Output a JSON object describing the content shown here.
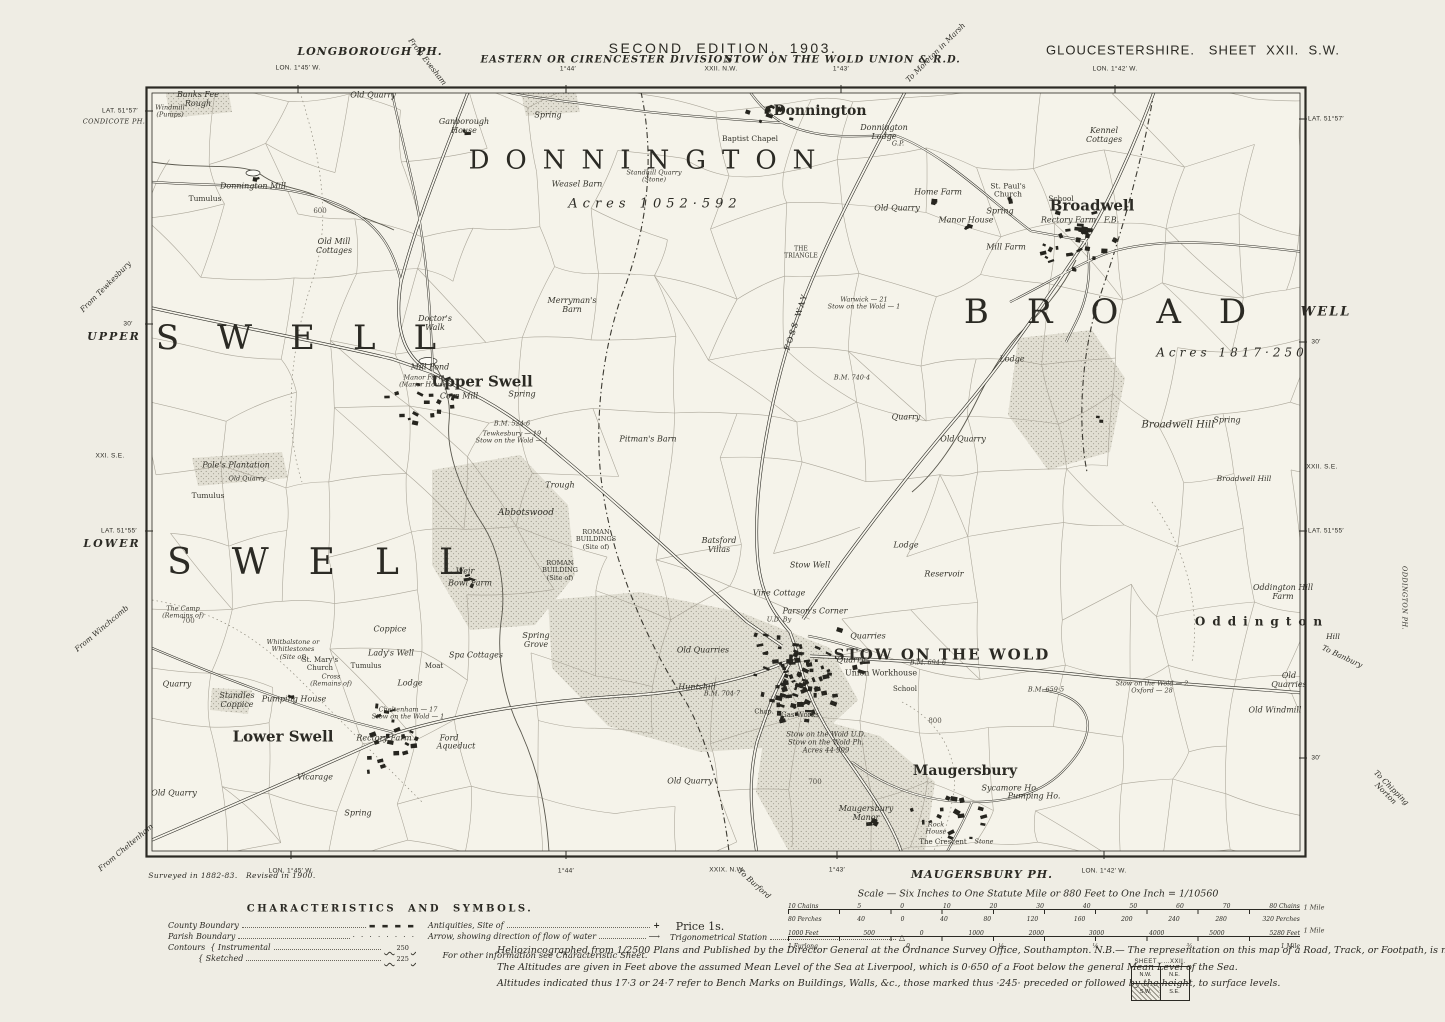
{
  "colors": {
    "paper": "#efede4",
    "map_interior": "#f5f3ea",
    "ink": "#2b2a24",
    "shade": "#dad7ca"
  },
  "header": {
    "edition_title": "SECOND  EDITION,  1903.",
    "county_sheet": "GLOUCESTERSHIRE.   SHEET  XXII.  S.W.",
    "division": "EASTERN OR CIRENCESTER DIVISION",
    "union": "STOW ON THE WOLD UNION & R.D.",
    "adjacent_sheet_top": "XXII. N.W.",
    "parish_top": "LONGBOROUGH PH."
  },
  "footer": {
    "survey_note": "Surveyed in 1882-83.   Revised in 1900.",
    "parish_bottom": "MAUGERSBURY PH.",
    "price": "Price 1s.",
    "lines": [
      "Heliozincographed from 1/2500 Plans and Published by the Director General at the Ordnance Survey Office, Southampton.    N.B.— The representation on this map of a Road, Track, or Footpath, is no evidence of the existence of a right of way.",
      "The Altitudes are given in Feet above the assumed Mean Level of the Sea at Liverpool, which is 0·650 of a Foot below the general Mean Level of the Sea.",
      "Altitudes indicated thus 17·3 or 24·7 refer to Bench Marks on Buildings, Walls, &c., those marked thus ·245· preceded or followed by the height, to surface levels."
    ]
  },
  "scale_bars": {
    "title": "Scale — Six Inches to One Statute Mile or 880 Feet to One Inch = 1/10560",
    "chains_top": [
      "10 Chains",
      "5",
      "0",
      "10",
      "20",
      "30",
      "40",
      "50",
      "60",
      "70",
      "80 Chains"
    ],
    "chains_bottom": [
      "80 Perches",
      "40",
      "0",
      "40",
      "80",
      "120",
      "160",
      "200",
      "240",
      "280",
      "320 Perches"
    ],
    "feet_top": [
      "1000 Feet",
      "500",
      "0",
      "1000",
      "2000",
      "3000",
      "4000",
      "5000",
      "5280 Feet"
    ],
    "feet_bottom": [
      "1 Furlong",
      "0",
      "¼",
      "½",
      "¾",
      "1 Mile"
    ]
  },
  "legend": {
    "title": "CHARACTERISTICS  AND  SYMBOLS.",
    "col1": [
      {
        "label": "County Boundary",
        "symbol": "county-dash"
      },
      {
        "label": "Parish Boundary",
        "symbol": "parish-dots"
      },
      {
        "label": "Contours  { Instrumental",
        "symbol": "contour-wave",
        "value": "250"
      },
      {
        "label": "{ Sketched",
        "symbol": "contour-wave",
        "value": "225"
      }
    ],
    "col2": [
      {
        "label": "Antiquities, Site of",
        "symbol": "antiquity-cross"
      },
      {
        "label": "Arrow, showing direction of flow of water",
        "symbol": "flow-arrow"
      }
    ],
    "col2_note": "For other information see Characteristic Sheet.",
    "col3": [
      {
        "label": "Trigonometrical Station",
        "symbol": "trig-triangle"
      }
    ]
  },
  "sheet_index": {
    "title": "SHEET",
    "number": "XXII.",
    "cells": [
      "N.W.",
      "N.E.",
      "S.W.",
      "S.E."
    ],
    "current": "S.W."
  },
  "labels": [
    {
      "t": "From Evesham",
      "x": 427,
      "y": 62,
      "c": "roaddest",
      "r": 52
    },
    {
      "t": "To Moreton in Marsh",
      "x": 936,
      "y": 53,
      "c": "roaddest",
      "r": -45
    },
    {
      "t": "LON. 1°45′ W.",
      "x": 298,
      "y": 68,
      "c": "mg"
    },
    {
      "t": "1°44′",
      "x": 568,
      "y": 69,
      "c": "mg"
    },
    {
      "t": "1°43′",
      "x": 841,
      "y": 69,
      "c": "mg"
    },
    {
      "t": "LON. 1°42′ W.",
      "x": 1115,
      "y": 69,
      "c": "mg"
    },
    {
      "t": "XXII. N.W.",
      "x": 721,
      "y": 69,
      "c": "mg"
    },
    {
      "t": "LAT. 51°57′",
      "x": 120,
      "y": 111,
      "c": "mg"
    },
    {
      "t": "CONDICOTE PH.",
      "x": 114,
      "y": 122,
      "c": "mgi"
    },
    {
      "t": "From Tewkesbury",
      "x": 106,
      "y": 287,
      "c": "roaddest",
      "r": -45
    },
    {
      "t": "30′",
      "x": 128,
      "y": 324,
      "c": "mg"
    },
    {
      "t": "UPPER",
      "x": 114,
      "y": 337,
      "c": "wellmg",
      "fs": 11
    },
    {
      "t": "XXI. S.E.",
      "x": 110,
      "y": 456,
      "c": "mg"
    },
    {
      "t": "LAT. 51°55′",
      "x": 119,
      "y": 531,
      "c": "mg"
    },
    {
      "t": "LOWER",
      "x": 112,
      "y": 544,
      "c": "wellmg",
      "fs": 11
    },
    {
      "t": "From Winchcomb",
      "x": 102,
      "y": 629,
      "c": "roaddest",
      "r": -40
    },
    {
      "t": "From Cheltenham",
      "x": 126,
      "y": 848,
      "c": "roaddest",
      "r": -40
    },
    {
      "t": "LAT. 51°57′",
      "x": 1326,
      "y": 119,
      "c": "mg"
    },
    {
      "t": "WELL",
      "x": 1326,
      "y": 313,
      "c": "wellmg",
      "fs": 13
    },
    {
      "t": "30′",
      "x": 1316,
      "y": 342,
      "c": "mg"
    },
    {
      "t": "XXII. S.E.",
      "x": 1322,
      "y": 467,
      "c": "mg"
    },
    {
      "t": "LAT. 51°55′",
      "x": 1326,
      "y": 531,
      "c": "mg"
    },
    {
      "t": "ODDINGTON PH.",
      "x": 1404,
      "y": 598,
      "c": "mgi",
      "r": 90
    },
    {
      "t": "Hill",
      "x": 1333,
      "y": 637,
      "c": "roaddest"
    },
    {
      "t": "To Banbury",
      "x": 1342,
      "y": 657,
      "c": "roaddest",
      "r": 25
    },
    {
      "t": "30′",
      "x": 1316,
      "y": 758,
      "c": "mg"
    },
    {
      "t": "To Chipping\nNorton",
      "x": 1388,
      "y": 791,
      "c": "roaddest",
      "r": 45
    },
    {
      "t": "LON. 1°45′ W.",
      "x": 291,
      "y": 871,
      "c": "mg"
    },
    {
      "t": "1°44′",
      "x": 566,
      "y": 871,
      "c": "mg"
    },
    {
      "t": "XXIX. N.W.",
      "x": 727,
      "y": 870,
      "c": "mg"
    },
    {
      "t": "To Burford",
      "x": 754,
      "y": 884,
      "c": "roaddest",
      "r": 42
    },
    {
      "t": "1°43′",
      "x": 837,
      "y": 870,
      "c": "mg"
    },
    {
      "t": "LON. 1°42′ W.",
      "x": 1104,
      "y": 871,
      "c": "mg"
    },
    {
      "t": "1 Mile",
      "x": 1314,
      "y": 908,
      "c": "ms"
    },
    {
      "t": "1 Mile",
      "x": 1314,
      "y": 931,
      "c": "ms"
    },
    {
      "t": "DONNINGTON",
      "x": 650,
      "y": 161,
      "c": "parish",
      "fs": 26,
      "ls": 16
    },
    {
      "t": "SWELL",
      "x": 315,
      "y": 338,
      "c": "parish",
      "fs": 34,
      "ls": 38
    },
    {
      "t": "BROAD",
      "x": 1124,
      "y": 312,
      "c": "parish",
      "fs": 34,
      "ls": 38
    },
    {
      "t": "SWELL",
      "x": 335,
      "y": 563,
      "c": "parish",
      "fs": 36,
      "ls": 40
    },
    {
      "t": "STOW ON THE WOLD",
      "x": 942,
      "y": 655,
      "c": "town",
      "fs": 15,
      "ls": 2
    },
    {
      "t": "Oddington",
      "x": 1262,
      "y": 622,
      "c": "town",
      "fs": 12,
      "ls": 7
    },
    {
      "t": "Acres 1052·592",
      "x": 655,
      "y": 205,
      "c": "acres",
      "ls": 5
    },
    {
      "t": "Acres 1817·250",
      "x": 1232,
      "y": 353,
      "c": "acres",
      "fs": 12,
      "ls": 4
    },
    {
      "t": "Donnington",
      "x": 820,
      "y": 112,
      "c": "village"
    },
    {
      "t": "Broadwell",
      "x": 1092,
      "y": 206,
      "c": "village",
      "fs": 15
    },
    {
      "t": "Upper Swell",
      "x": 482,
      "y": 382,
      "c": "village",
      "fs": 15
    },
    {
      "t": "Lower Swell",
      "x": 283,
      "y": 737,
      "c": "village",
      "fs": 15
    },
    {
      "t": "Maugersbury",
      "x": 965,
      "y": 772,
      "c": "village"
    },
    {
      "t": "Banks Fee\nRough",
      "x": 198,
      "y": 100,
      "c": "place"
    },
    {
      "t": "Windmill\n(Pumps)",
      "x": 170,
      "y": 112,
      "c": "ms"
    },
    {
      "t": "Old Quarry",
      "x": 373,
      "y": 96,
      "c": "place"
    },
    {
      "t": "Ganborough\nHouse",
      "x": 464,
      "y": 127,
      "c": "place"
    },
    {
      "t": "Spring",
      "x": 548,
      "y": 116,
      "c": "place"
    },
    {
      "t": "Baptist Chapel",
      "x": 750,
      "y": 139,
      "c": "placerm"
    },
    {
      "t": "Donnington Mill",
      "x": 253,
      "y": 187,
      "c": "place"
    },
    {
      "t": "Tumulus",
      "x": 205,
      "y": 199,
      "c": "placerm"
    },
    {
      "t": "Old Mill\nCottages",
      "x": 334,
      "y": 247,
      "c": "place"
    },
    {
      "t": "Weasel Barn",
      "x": 577,
      "y": 185,
      "c": "place"
    },
    {
      "t": "Standhill Quarry\n(Stone)",
      "x": 654,
      "y": 177,
      "c": "ms"
    },
    {
      "t": "Donnington\nLodge",
      "x": 884,
      "y": 133,
      "c": "place"
    },
    {
      "t": "G.P.",
      "x": 898,
      "y": 144,
      "c": "ms"
    },
    {
      "t": "Home Farm",
      "x": 938,
      "y": 193,
      "c": "place"
    },
    {
      "t": "St. Paul's\nChurch",
      "x": 1008,
      "y": 191,
      "c": "placerm"
    },
    {
      "t": "Spring",
      "x": 1000,
      "y": 212,
      "c": "place"
    },
    {
      "t": "Old Quarry",
      "x": 897,
      "y": 209,
      "c": "place"
    },
    {
      "t": "Manor House",
      "x": 966,
      "y": 221,
      "c": "place"
    },
    {
      "t": "Kennel\nCottages",
      "x": 1104,
      "y": 136,
      "c": "place"
    },
    {
      "t": "School",
      "x": 1061,
      "y": 199,
      "c": "placerm"
    },
    {
      "t": "Rectory Farm   F.B.",
      "x": 1080,
      "y": 221,
      "c": "place"
    },
    {
      "t": "Mill Farm",
      "x": 1006,
      "y": 248,
      "c": "place"
    },
    {
      "t": "THE\nTRIANGLE",
      "x": 801,
      "y": 253,
      "c": "placerm",
      "fs": 6
    },
    {
      "t": "Warwick — 21\nStow on the Wold — 1",
      "x": 864,
      "y": 304,
      "c": "ms"
    },
    {
      "t": "FOSS WAY",
      "x": 797,
      "y": 322,
      "c": "fossway",
      "r": -72
    },
    {
      "t": "Merryman's\nBarn",
      "x": 572,
      "y": 306,
      "c": "place"
    },
    {
      "t": "Doctor's\nWalk",
      "x": 435,
      "y": 324,
      "c": "place"
    },
    {
      "t": "Mill Pond",
      "x": 430,
      "y": 368,
      "c": "place"
    },
    {
      "t": "Manor Farm\n(Manor House)",
      "x": 424,
      "y": 382,
      "c": "ms"
    },
    {
      "t": "Corn Mill",
      "x": 459,
      "y": 397,
      "c": "place"
    },
    {
      "t": "Spring",
      "x": 522,
      "y": 395,
      "c": "place"
    },
    {
      "t": "Tewkesbury — 19\nStow on the Wold — 1",
      "x": 512,
      "y": 438,
      "c": "ms"
    },
    {
      "t": "Pitman's Barn",
      "x": 648,
      "y": 440,
      "c": "place"
    },
    {
      "t": "Pole's Plantation",
      "x": 236,
      "y": 466,
      "c": "place"
    },
    {
      "t": "Old Quarry",
      "x": 247,
      "y": 479,
      "c": "ms"
    },
    {
      "t": "Tumulus",
      "x": 208,
      "y": 496,
      "c": "placerm"
    },
    {
      "t": "Trough",
      "x": 560,
      "y": 486,
      "c": "place"
    },
    {
      "t": "Abbotswood",
      "x": 526,
      "y": 513,
      "c": "placei"
    },
    {
      "t": "ROMAN\nBUILDINGS\n(Site of)",
      "x": 596,
      "y": 540,
      "c": "placerm",
      "fs": 6.5
    },
    {
      "t": "ROMAN\nBUILDING\n(Site of)",
      "x": 560,
      "y": 571,
      "c": "placerm",
      "fs": 6.5
    },
    {
      "t": "Batsford\nVillas",
      "x": 719,
      "y": 546,
      "c": "place"
    },
    {
      "t": "Stow Well",
      "x": 810,
      "y": 566,
      "c": "place"
    },
    {
      "t": "Reservoir",
      "x": 944,
      "y": 575,
      "c": "place"
    },
    {
      "t": "Lodge",
      "x": 906,
      "y": 546,
      "c": "place"
    },
    {
      "t": "Vine Cottage",
      "x": 779,
      "y": 594,
      "c": "place"
    },
    {
      "t": "Parson's Corner",
      "x": 815,
      "y": 612,
      "c": "place"
    },
    {
      "t": "U.D. By",
      "x": 779,
      "y": 620,
      "c": "ms"
    },
    {
      "t": "Quarries",
      "x": 868,
      "y": 637,
      "c": "place"
    },
    {
      "t": "Quarry",
      "x": 851,
      "y": 661,
      "c": "place"
    },
    {
      "t": "Old Quarries",
      "x": 703,
      "y": 651,
      "c": "place"
    },
    {
      "t": "Union Workhouse",
      "x": 881,
      "y": 674,
      "c": "placerm",
      "fs": 8
    },
    {
      "t": "School",
      "x": 905,
      "y": 690,
      "c": "placerm",
      "fs": 7
    },
    {
      "t": "Huntshill",
      "x": 697,
      "y": 688,
      "c": "place"
    },
    {
      "t": "Gas Works",
      "x": 800,
      "y": 716,
      "c": "placerm",
      "fs": 7
    },
    {
      "t": "Chap.",
      "x": 764,
      "y": 712,
      "c": "placerm",
      "fs": 6.5
    },
    {
      "t": "B.M. 740·4",
      "x": 852,
      "y": 378,
      "c": "ms"
    },
    {
      "t": "B.M. 524·6",
      "x": 512,
      "y": 424,
      "c": "ms"
    },
    {
      "t": "B.M. 704·7",
      "x": 722,
      "y": 694,
      "c": "ms"
    },
    {
      "t": "B.M. 694·6",
      "x": 928,
      "y": 663,
      "c": "ms"
    },
    {
      "t": "B.M. 659·5",
      "x": 1046,
      "y": 690,
      "c": "ms"
    },
    {
      "t": "The Camp\n(Remains of)",
      "x": 183,
      "y": 613,
      "c": "ms"
    },
    {
      "t": "Whitbalstone or\nWhitlestones\n(Site of)",
      "x": 293,
      "y": 650,
      "c": "ms"
    },
    {
      "t": "St. Mary's\nChurch",
      "x": 320,
      "y": 665,
      "c": "placerm",
      "fs": 7
    },
    {
      "t": "Cross\n(Remains of)",
      "x": 331,
      "y": 681,
      "c": "ms"
    },
    {
      "t": "Tumulus",
      "x": 366,
      "y": 667,
      "c": "placerm",
      "fs": 7
    },
    {
      "t": "Weir",
      "x": 465,
      "y": 572,
      "c": "place"
    },
    {
      "t": "Bowl Farm",
      "x": 470,
      "y": 584,
      "c": "place"
    },
    {
      "t": "Coppice",
      "x": 390,
      "y": 630,
      "c": "place"
    },
    {
      "t": "Lady's Well",
      "x": 391,
      "y": 654,
      "c": "place"
    },
    {
      "t": "Moat",
      "x": 434,
      "y": 667,
      "c": "placerm",
      "fs": 7
    },
    {
      "t": "Lodge",
      "x": 410,
      "y": 684,
      "c": "place"
    },
    {
      "t": "Spa Cottages",
      "x": 476,
      "y": 656,
      "c": "place"
    },
    {
      "t": "Spring\nGrove",
      "x": 536,
      "y": 641,
      "c": "place"
    },
    {
      "t": "Quarry",
      "x": 177,
      "y": 685,
      "c": "place"
    },
    {
      "t": "Standles\nCoppice",
      "x": 237,
      "y": 701,
      "c": "place"
    },
    {
      "t": "Pumping House",
      "x": 294,
      "y": 700,
      "c": "place"
    },
    {
      "t": "Cheltenham — 17\nStow on the Wold — 1",
      "x": 408,
      "y": 714,
      "c": "ms"
    },
    {
      "t": "Rectory Farm",
      "x": 384,
      "y": 739,
      "c": "place"
    },
    {
      "t": "Ford",
      "x": 449,
      "y": 739,
      "c": "place"
    },
    {
      "t": "Aqueduct",
      "x": 456,
      "y": 747,
      "c": "place"
    },
    {
      "t": "Vicarage",
      "x": 315,
      "y": 778,
      "c": "place"
    },
    {
      "t": "Old Quarry",
      "x": 174,
      "y": 794,
      "c": "place"
    },
    {
      "t": "Spring",
      "x": 358,
      "y": 814,
      "c": "place"
    },
    {
      "t": "Old Quarry",
      "x": 690,
      "y": 782,
      "c": "place"
    },
    {
      "t": "Stow on the Wold U.D.\nStow on the Wold Ph.\nAcres 44·909",
      "x": 826,
      "y": 743,
      "c": "ms",
      "fs": 7
    },
    {
      "t": "Maugersbury\nManor",
      "x": 866,
      "y": 814,
      "c": "place"
    },
    {
      "t": "Sycamore Ho.",
      "x": 1010,
      "y": 789,
      "c": "place"
    },
    {
      "t": "Pumping Ho.",
      "x": 1034,
      "y": 797,
      "c": "place"
    },
    {
      "t": "Rock\nHouse",
      "x": 936,
      "y": 829,
      "c": "ms"
    },
    {
      "t": "The Crescent",
      "x": 943,
      "y": 843,
      "c": "placerm",
      "fs": 7
    },
    {
      "t": "Stone",
      "x": 984,
      "y": 842,
      "c": "ms"
    },
    {
      "t": "800",
      "x": 935,
      "y": 722,
      "c": "ctr"
    },
    {
      "t": "700",
      "x": 188,
      "y": 622,
      "c": "ctr"
    },
    {
      "t": "600",
      "x": 320,
      "y": 212,
      "c": "ctr"
    },
    {
      "t": "700",
      "x": 815,
      "y": 783,
      "c": "ctr"
    },
    {
      "t": "Broadwell Hill",
      "x": 1178,
      "y": 425,
      "c": "placei",
      "fs": 10
    },
    {
      "t": "Broadwell Hill",
      "x": 1244,
      "y": 479,
      "c": "place",
      "fs": 7.5
    },
    {
      "t": "Spring",
      "x": 1227,
      "y": 421,
      "c": "place"
    },
    {
      "t": "Lodge",
      "x": 1012,
      "y": 360,
      "c": "place"
    },
    {
      "t": "Quarry",
      "x": 906,
      "y": 418,
      "c": "place"
    },
    {
      "t": "Old Quarry",
      "x": 963,
      "y": 440,
      "c": "place"
    },
    {
      "t": "Oddington Hill\nFarm",
      "x": 1283,
      "y": 593,
      "c": "place"
    },
    {
      "t": "Old\nQuarries",
      "x": 1289,
      "y": 681,
      "c": "place"
    },
    {
      "t": "Old Windmill",
      "x": 1275,
      "y": 711,
      "c": "place"
    },
    {
      "t": "Stow on the Wold — 2\nOxford — 28",
      "x": 1152,
      "y": 688,
      "c": "ms"
    }
  ]
}
